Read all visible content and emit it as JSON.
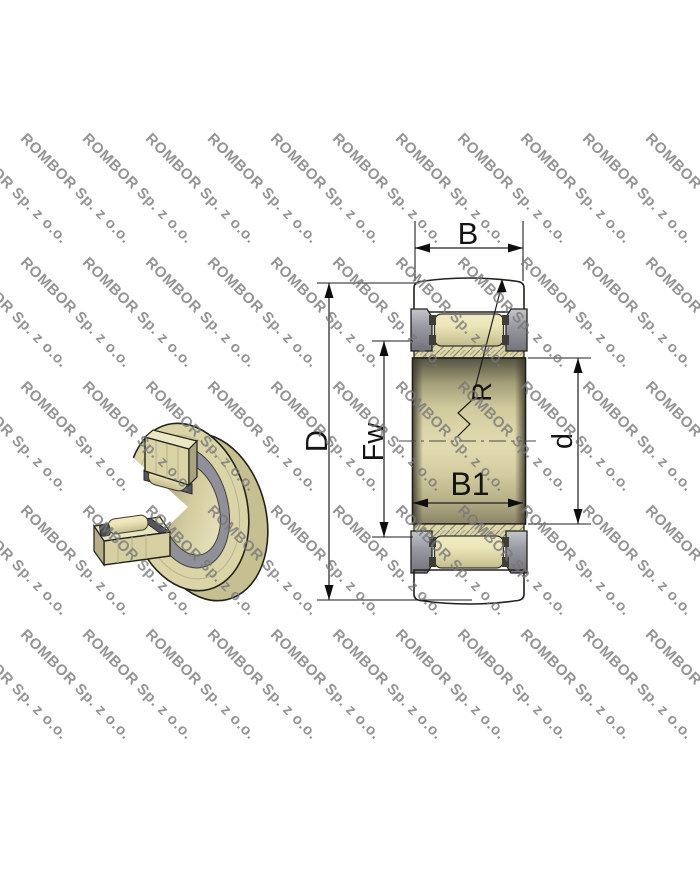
{
  "watermark": {
    "text": "ROMBOR Sp. z o.o.",
    "angle_deg": 45
  },
  "figure": {
    "type": "needle-roller-bearing technical drawing",
    "views": {
      "left": "3d-cutaway-bearing",
      "right": "dimensioned-cross-section"
    },
    "labels": {
      "outer_ring_width": "B",
      "outer_diameter": "D",
      "raceway_diameter": "Fw",
      "crown_radius": "R",
      "bore_diameter": "d",
      "inner_ring_width": "B1"
    },
    "colors": {
      "background": "#ffffff",
      "steel_tan": "#d8d2a4",
      "hatch_fill": "#ddd7ab",
      "hatch_line": "#8e8c70",
      "flange_gray": "#90909a",
      "roller_cream": "#ece6bd",
      "outline": "#23211b",
      "dimension": "#1e1e1e",
      "watermark_gray": "#777777"
    }
  }
}
